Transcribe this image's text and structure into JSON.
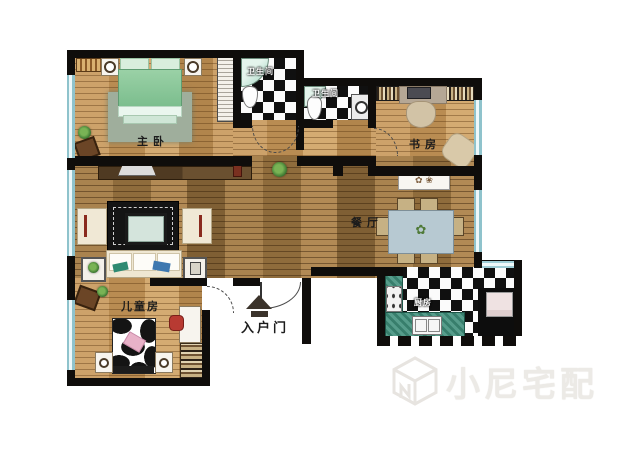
{
  "page": {
    "type": "apartment-floor-plan"
  },
  "rooms": {
    "master_bedroom": {
      "label": "主卧"
    },
    "bathroom_main": {
      "label": "卫生间"
    },
    "bathroom_second": {
      "label": "卫生间"
    },
    "study": {
      "label": "书房"
    },
    "dining_room": {
      "label": "餐厅"
    },
    "children_room": {
      "label": "儿童房"
    },
    "kitchen": {
      "label": "厨房"
    },
    "entrance": {
      "label": "入户门"
    }
  },
  "watermark": {
    "brand": "小尼宅配",
    "logo": "cube-n-logo"
  },
  "colors": {
    "wall": "#0f0d0b",
    "wood_light": "#c59a63",
    "wood_dark": "#9a7848",
    "checker_dark": "#101010",
    "counter_teal": "#3f8f7b",
    "window_blue": "#aedce2",
    "bed_green": "#9ed2a8",
    "pillow_pink": "#e8b2c8",
    "watermark_gray": "#eceae6"
  }
}
